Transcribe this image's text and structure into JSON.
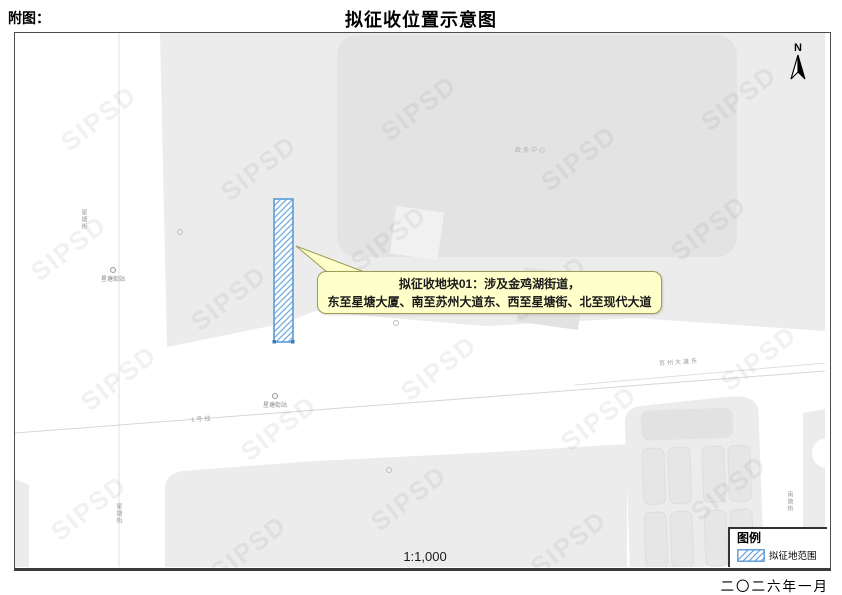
{
  "page": {
    "figure_label": "附图：",
    "title": "拟征收位置示意图"
  },
  "map": {
    "watermark": "SIPSD",
    "north_label": "N",
    "scale_text": "1:1,000",
    "labels": {
      "road_left_top": "星塘街",
      "road_left_bottom": "星塘街",
      "station_west": "星塘街站",
      "station_main": "星塘街站",
      "metro_line": "1号线",
      "road_main": "苏州大道东",
      "road_right": "南施街",
      "building_top": "政务中心"
    },
    "callout": {
      "line1": "拟征收地块01：涉及金鸡湖街道，",
      "line2": "东至星塘大厦、南至苏州大道东、西至星塘街、北至现代大道"
    },
    "colors": {
      "parcel_blue": "#5b9bd5",
      "callout_fill": "#ffffca",
      "block_gray": "#ececec",
      "building_gray": "#e3e3e3"
    }
  },
  "legend": {
    "title": "图例",
    "item_label": "拟征地范围"
  },
  "footer": {
    "date": "二〇二六年一月"
  }
}
